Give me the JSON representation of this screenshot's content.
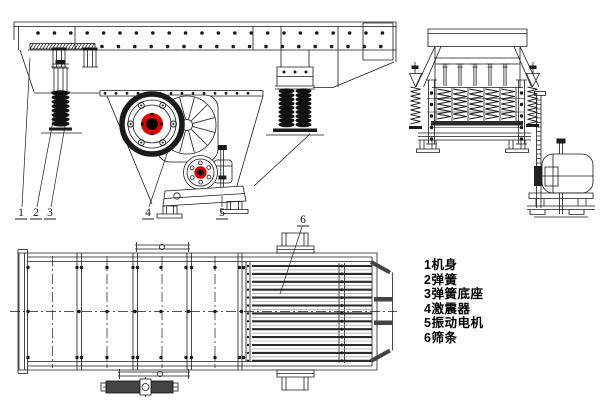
{
  "callouts": [
    "1",
    "2",
    "3",
    "4",
    "5",
    "6"
  ],
  "parts_list": [
    "1机身",
    "2弹簧",
    "3弹簧底座",
    "4激震器",
    "5振动电机",
    "6筛条"
  ],
  "colors": {
    "line": "#1a1a1a",
    "accent_red": "#e10000",
    "bar_dark": "#2b2b2b",
    "hatch_dark": "#444444",
    "paper": "#ffffff"
  }
}
